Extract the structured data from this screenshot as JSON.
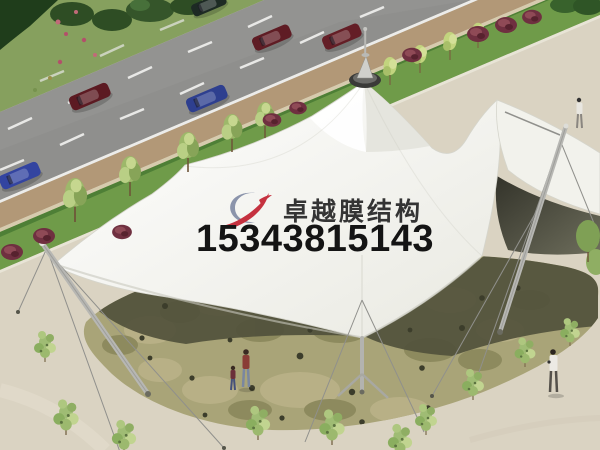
{
  "watermark": {
    "company_name": "卓越膜结构",
    "phone_number": "15343815143",
    "logo_red": "#c5313f",
    "logo_gray_blue": "#8b94ab",
    "name_color": "#343434",
    "phone_color": "#141414"
  },
  "scene": {
    "subject": "aerial rendering of white tensile membrane canopy over stone plaza beside a road",
    "palette": {
      "membrane_white": "#f8f8f4",
      "membrane_underside_dark": "#45453a",
      "ground_shadow": "#51513c",
      "plaza_beige": "#dad3c2",
      "stone_paving_olive": "#a9a478",
      "road_gray": "#939391",
      "green_strip": "#6f9b49",
      "sidewalk_tan": "#b29877",
      "car_dark_red": "#5c1a22",
      "car_blue": "#2e3f8f",
      "shrub_green": "#9fbc74"
    }
  }
}
